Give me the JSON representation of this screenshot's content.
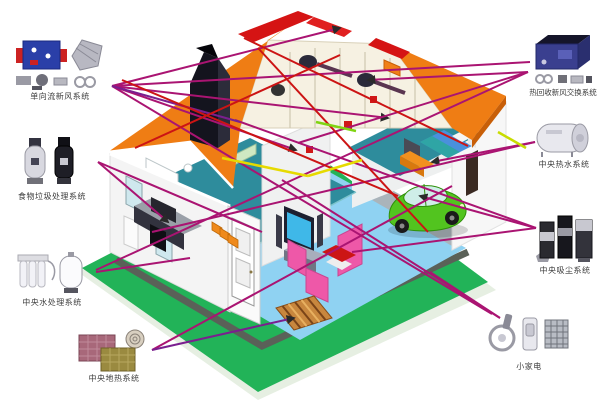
{
  "systems": [
    {
      "id": "fresh-air",
      "label": "单向流新风系统"
    },
    {
      "id": "food-waste",
      "label": "食物垃圾处理系统"
    },
    {
      "id": "water-treatment",
      "label": "中央水处理系统"
    },
    {
      "id": "floor-heating",
      "label": "中央地热系统"
    },
    {
      "id": "heat-recovery",
      "label": "热回收新风交换系统"
    },
    {
      "id": "hot-water",
      "label": "中央热水系统"
    },
    {
      "id": "vacuum",
      "label": "中央吸尘系统"
    },
    {
      "id": "small-appliances",
      "label": "小家电"
    }
  ],
  "palette": {
    "roof_orange": "#ef7d14",
    "ridge_red": "#d51414",
    "lawn_green": "#22b358",
    "upper_floor_teal": "#2e8c9c",
    "ground_floor_blue": "#8fd2f2",
    "line_magenta": "#aa1472",
    "line_purple": "#7a1f8f",
    "line_red": "#cc1414",
    "line_yellow": "#e6da00",
    "line_green": "#7fd410",
    "sofa_pink": "#ee58a8",
    "car_green": "#52c41f"
  }
}
